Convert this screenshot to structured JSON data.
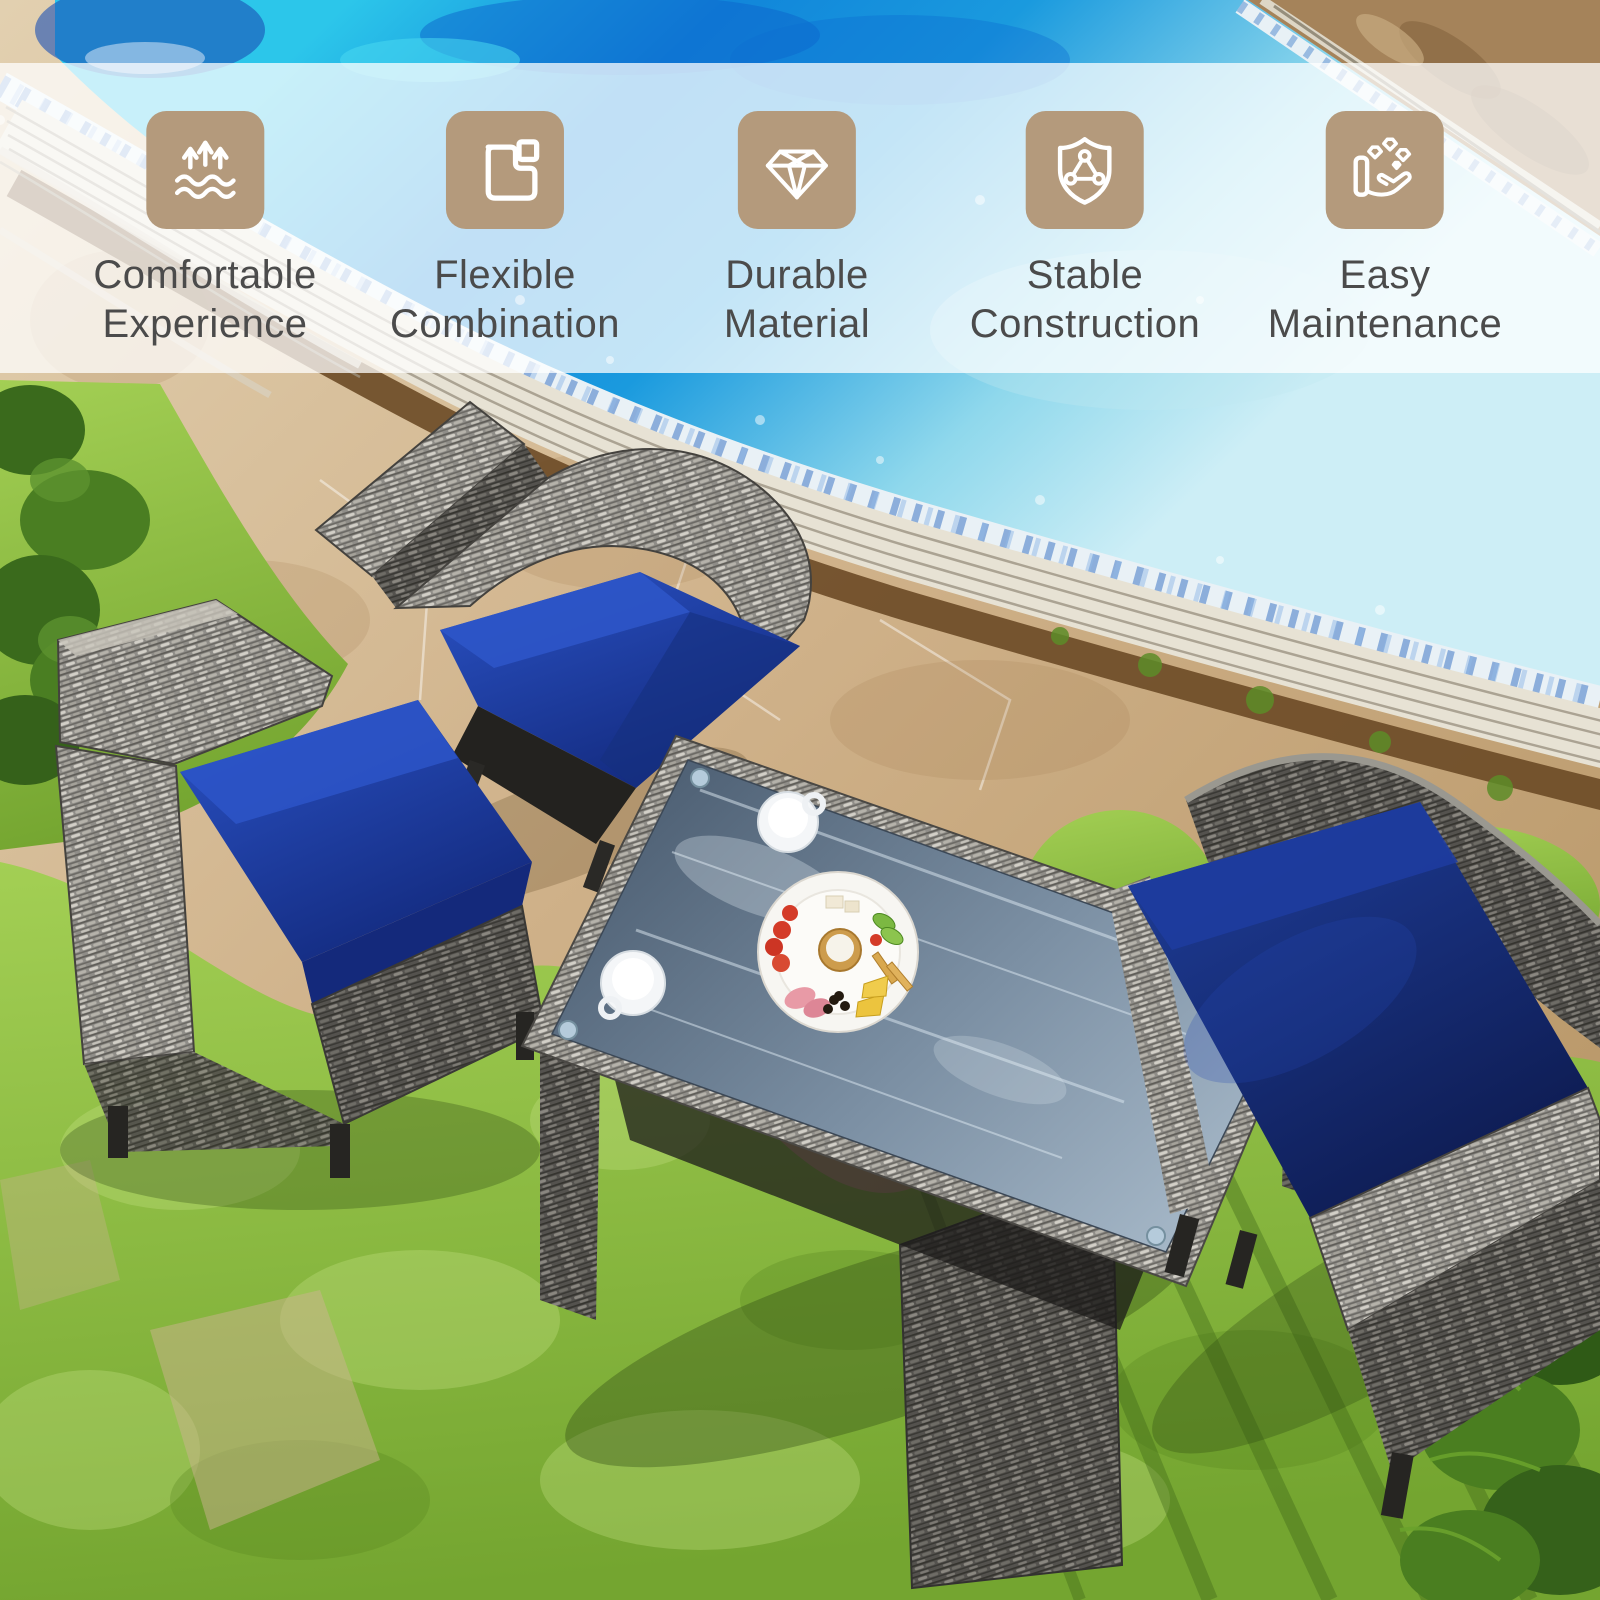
{
  "feature_banner": {
    "items": [
      {
        "icon": "breathable-waves-icon",
        "line1": "Comfortable",
        "line2": "Experience"
      },
      {
        "icon": "modular-combination-icon",
        "line1": "Flexible",
        "line2": "Combination"
      },
      {
        "icon": "diamond-icon",
        "line1": "Durable",
        "line2": "Material"
      },
      {
        "icon": "shield-structure-icon",
        "line1": "Stable",
        "line2": "Construction"
      },
      {
        "icon": "hand-care-icon",
        "line1": "Easy",
        "line2": "Maintenance"
      }
    ]
  },
  "palette": {
    "icon_bg": "#b49a7c",
    "icon_glyph": "#ffffff",
    "label_text": "#4b4b4b",
    "banner_overlay": "rgba(255,255,255,0.74)",
    "cushion_blue": "#1d3fa6",
    "cushion_blue_dark": "#12266e",
    "water_turquoise": "#2cc6ea",
    "water_deep_blue": "#0f78d4",
    "water_pale": "#cdeef6",
    "stone_tan": "#c9aa7f",
    "coping_light": "#e7e2d4",
    "grass_green": "#8abc42",
    "grass_shadow": "#3e6617",
    "wicker_gray": "#93918c",
    "wicker_dark": "#4a4845",
    "glass_gray": "#7c90a4",
    "plate_white": "#f7f6f2"
  }
}
